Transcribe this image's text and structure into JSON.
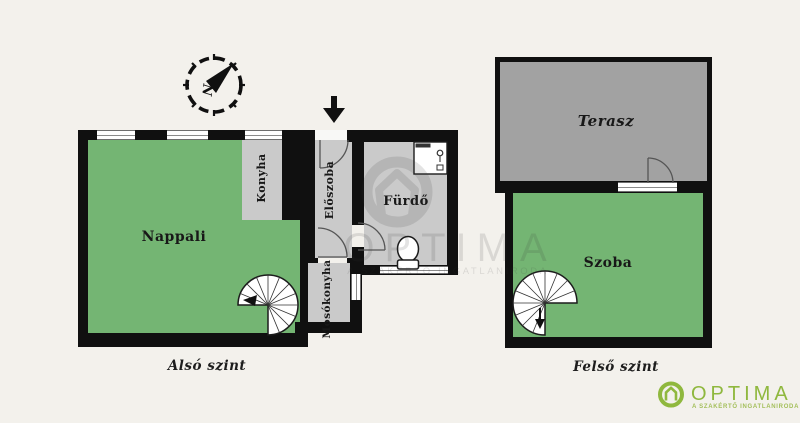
{
  "colors": {
    "background": "#f3f1ec",
    "wall": "#101010",
    "room_gray": "#cacaca",
    "terrace_gray": "#a2a2a2",
    "room_green": "#74b573",
    "brand_green": "#8fb83e"
  },
  "compass": {
    "north_label": "N"
  },
  "lower_floor": {
    "caption": "Alsó szint",
    "rooms": {
      "nappali": "Nappali",
      "konyha": "Konyha",
      "eloszoba": "Előszoba",
      "furdo": "Fürdő",
      "mosokonyha": "Mosókonyha"
    }
  },
  "upper_floor": {
    "caption": "Felső szint",
    "rooms": {
      "terasz": "Terasz",
      "szoba": "Szoba"
    }
  },
  "watermark": {
    "brand": "OPTIMA",
    "tagline": "A SZAKÉRTŐ INGATLANIRODA"
  },
  "logo": {
    "brand": "OPTIMA",
    "tagline": "A SZAKÉRTŐ INGATLANIRODA"
  }
}
